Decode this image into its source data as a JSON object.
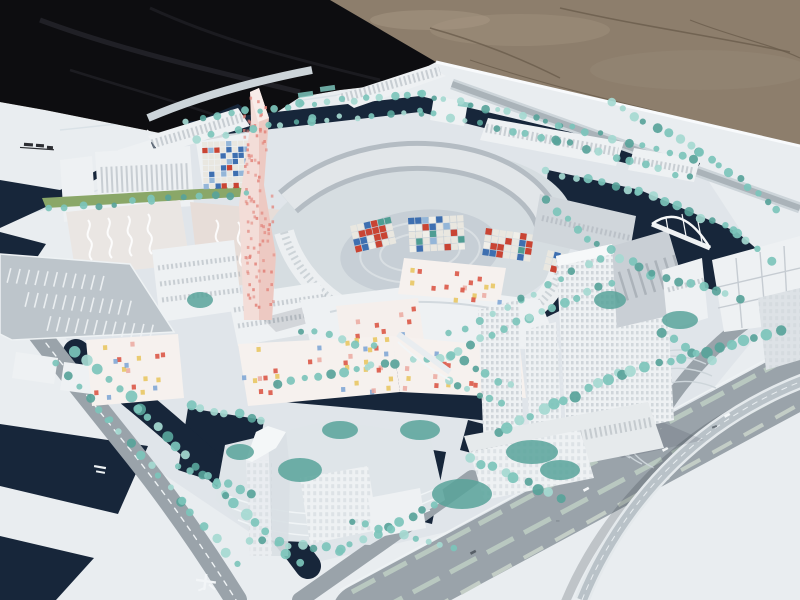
{
  "meta": {
    "title": "Outdoor photograph of a white architectural scale model of a waterfront city district",
    "domain_note": "physical model on a white baseboard, black tarp and gravel ground behind"
  },
  "scene": {
    "labels": {
      "ground": "sun-lit gravel ground",
      "tarp": "black tarp covering ground at upper left",
      "board": "white model baseboard in perspective",
      "pink_tower": "tall twisted pink landmark tower with dotted facade",
      "ring": "elliptical courtyard building ring with colored mosaic inner facade",
      "confetti": "low buildings with multicolored confetti windows",
      "right_towers": "group of tall white gridded office towers by the canal",
      "translucent_tower": "translucent high-rise on island at bottom",
      "lake": "dark navy canal and lake network",
      "bridge": "white arched pedestrian bridges",
      "boulevard": "wide grey boulevard with planted medians and flyover ramp",
      "parking": "striped parking lot at left",
      "trees": "rows of teal glass model trees",
      "rail_marking": "small dark rail-line marking printed on the board",
      "road_symbol": "small white symbol printed on the road"
    }
  },
  "colors": {
    "dirt": "#8d7e6c",
    "dirtLight": "#a0927f",
    "dirtCrack": "#6a5c4c",
    "tarp": "#0d0d10",
    "tarpFold": "#2a2a30",
    "board": "#e9edf0",
    "plaza": "#dfe5e9",
    "water": "#17263a",
    "waterEdge": "#2e4a55",
    "treeLight": "#a5d9d1",
    "treeMid": "#7cc4bb",
    "treeDark": "#58a39a",
    "grass": "#8aa768",
    "road": "#9aa3aa",
    "roadLight": "#b7bfc5",
    "marking": "#eef2f4",
    "buildingWhite": "#eef1f3",
    "buildingFace": "#dde2e6",
    "buildingShade": "#c3cad0",
    "winDark": "#a9b1b8",
    "pinkTowerL": "#f3ddd8",
    "pinkTowerR": "#edc9c2",
    "pinkDot": "#e2837a",
    "mosaic": [
      "#c94433",
      "#3e6fb0",
      "#e9e7e0",
      "#94b6d8",
      "#4f9d93",
      "#f0efe9",
      "#c94433",
      "#3e6fb0"
    ],
    "winAccent": [
      "#c94433",
      "#3e6fb0",
      "#e9e7e0",
      "#e9e7e0",
      "#94b6d8"
    ],
    "confetti": [
      "#d94f3d",
      "#e8c45a",
      "#7aa3d4",
      "#eba9a0",
      "#d94f3d",
      "#e8c45a"
    ]
  }
}
